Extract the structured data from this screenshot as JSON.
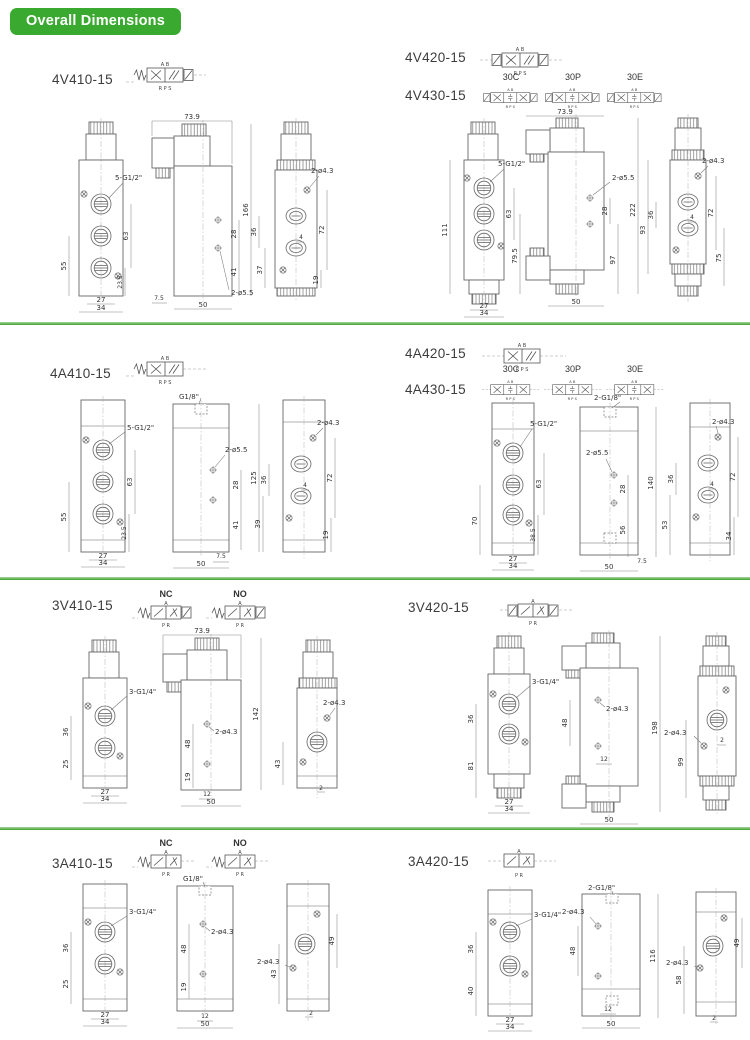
{
  "page": {
    "title": "Overall Dimensions",
    "green": "#3aa92f"
  },
  "sym": {
    "t5": "A B",
    "b5": "R P S",
    "t3": "A",
    "b3": "P R"
  },
  "variants": [
    "30C",
    "30P",
    "30E"
  ],
  "nc": "NC",
  "no": "NO",
  "s1": {
    "m1": "4V410-15",
    "m2": "4V420-15",
    "m3": "4V430-15",
    "L": {
      "fv": {
        "thread": "5-G1/2\"",
        "a": "63",
        "b": "55",
        "c": "23.5",
        "w1": "27",
        "w2": "34"
      },
      "sv": {
        "wt": "73.9",
        "h": "166",
        "a": "28",
        "b": "41",
        "c": "7.5",
        "wb": "50",
        "holes": "2-ø5.5"
      },
      "bv": {
        "holes": "2-ø4.3",
        "a": "36",
        "b": "37",
        "c": "4",
        "d": "72",
        "e": "19"
      }
    },
    "R": {
      "fv": {
        "thread": "5-G1/2\"",
        "a": "63",
        "b": "111",
        "c": "79.5",
        "w1": "27",
        "w2": "34"
      },
      "sv": {
        "wt": "73.9",
        "h": "222",
        "a": "28",
        "b": "97",
        "wb": "50",
        "holes": "2-ø5.5"
      },
      "bv": {
        "holes": "2-ø4.3",
        "a": "36",
        "b": "4",
        "c": "72",
        "d": "93",
        "e": "75"
      }
    }
  },
  "s2": {
    "m1": "4A410-15",
    "m2": "4A420-15",
    "m3": "4A430-15",
    "L": {
      "fv": {
        "thread": "5-G1/2\"",
        "a": "63",
        "b": "55",
        "c": "23.5",
        "w1": "27",
        "w2": "34"
      },
      "sv": {
        "tp": "G1/8\"",
        "holes": "2-ø5.5",
        "a": "28",
        "h": "125",
        "b": "41",
        "c": "7.5",
        "wb": "50"
      },
      "bv": {
        "holes": "2-ø4.3",
        "a": "36",
        "b": "4",
        "c": "72",
        "d": "39",
        "e": "19"
      }
    },
    "R": {
      "fv": {
        "thread": "5-G1/2\"",
        "a": "63",
        "b": "70",
        "c": "38.5",
        "w1": "27",
        "w2": "34"
      },
      "sv": {
        "tp": "2-G1/8\"",
        "holes": "2-ø5.5",
        "a": "28",
        "h": "140",
        "b": "56",
        "c": "7.5",
        "wb": "50"
      },
      "bv": {
        "holes": "2-ø4.3",
        "a": "36",
        "b": "4",
        "c": "72",
        "d": "53",
        "e": "34"
      }
    }
  },
  "s3": {
    "m1": "3V410-15",
    "m2": "3V420-15",
    "L": {
      "fv": {
        "thread": "3-G1/4\"",
        "a": "36",
        "b": "25",
        "w1": "27",
        "w2": "34"
      },
      "sv": {
        "wt": "73.9",
        "h": "142",
        "a": "48",
        "holes": "2-ø4.3",
        "b": "19",
        "c": "12",
        "wb": "50"
      },
      "bv": {
        "holes": "2-ø4.3",
        "a": "43",
        "b": "2"
      }
    },
    "R": {
      "fv": {
        "thread": "3-G1/4\"",
        "a": "36",
        "b": "81",
        "w1": "27",
        "w2": "34"
      },
      "sv": {
        "a": "48",
        "holes": "2-ø4.3",
        "b": "12",
        "h": "198",
        "wb": "50"
      },
      "bv": {
        "holes": "2-ø4.3",
        "a": "2",
        "b": "99"
      }
    }
  },
  "s4": {
    "m1": "3A410-15",
    "m2": "3A420-15",
    "L": {
      "fv": {
        "thread": "3-G1/4\"",
        "a": "36",
        "b": "25",
        "w1": "27",
        "w2": "34"
      },
      "sv": {
        "tp": "G1/8\"",
        "a": "48",
        "holes": "2-ø4.3",
        "b": "19",
        "c": "12",
        "wb": "50"
      },
      "bv": {
        "holes": "2-ø4.3",
        "a": "43",
        "b": "49",
        "c": "2"
      }
    },
    "R": {
      "fv": {
        "thread": "3-G1/4\"",
        "a": "36",
        "b": "40",
        "w1": "27",
        "w2": "34"
      },
      "sv": {
        "tp": "2-G1/8\"",
        "holes": "2-ø4.3",
        "a": "48",
        "h": "116",
        "b": "12",
        "wb": "50"
      },
      "bv": {
        "holes": "2-ø4.3",
        "a": "49",
        "b": "58",
        "c": "2"
      }
    }
  }
}
